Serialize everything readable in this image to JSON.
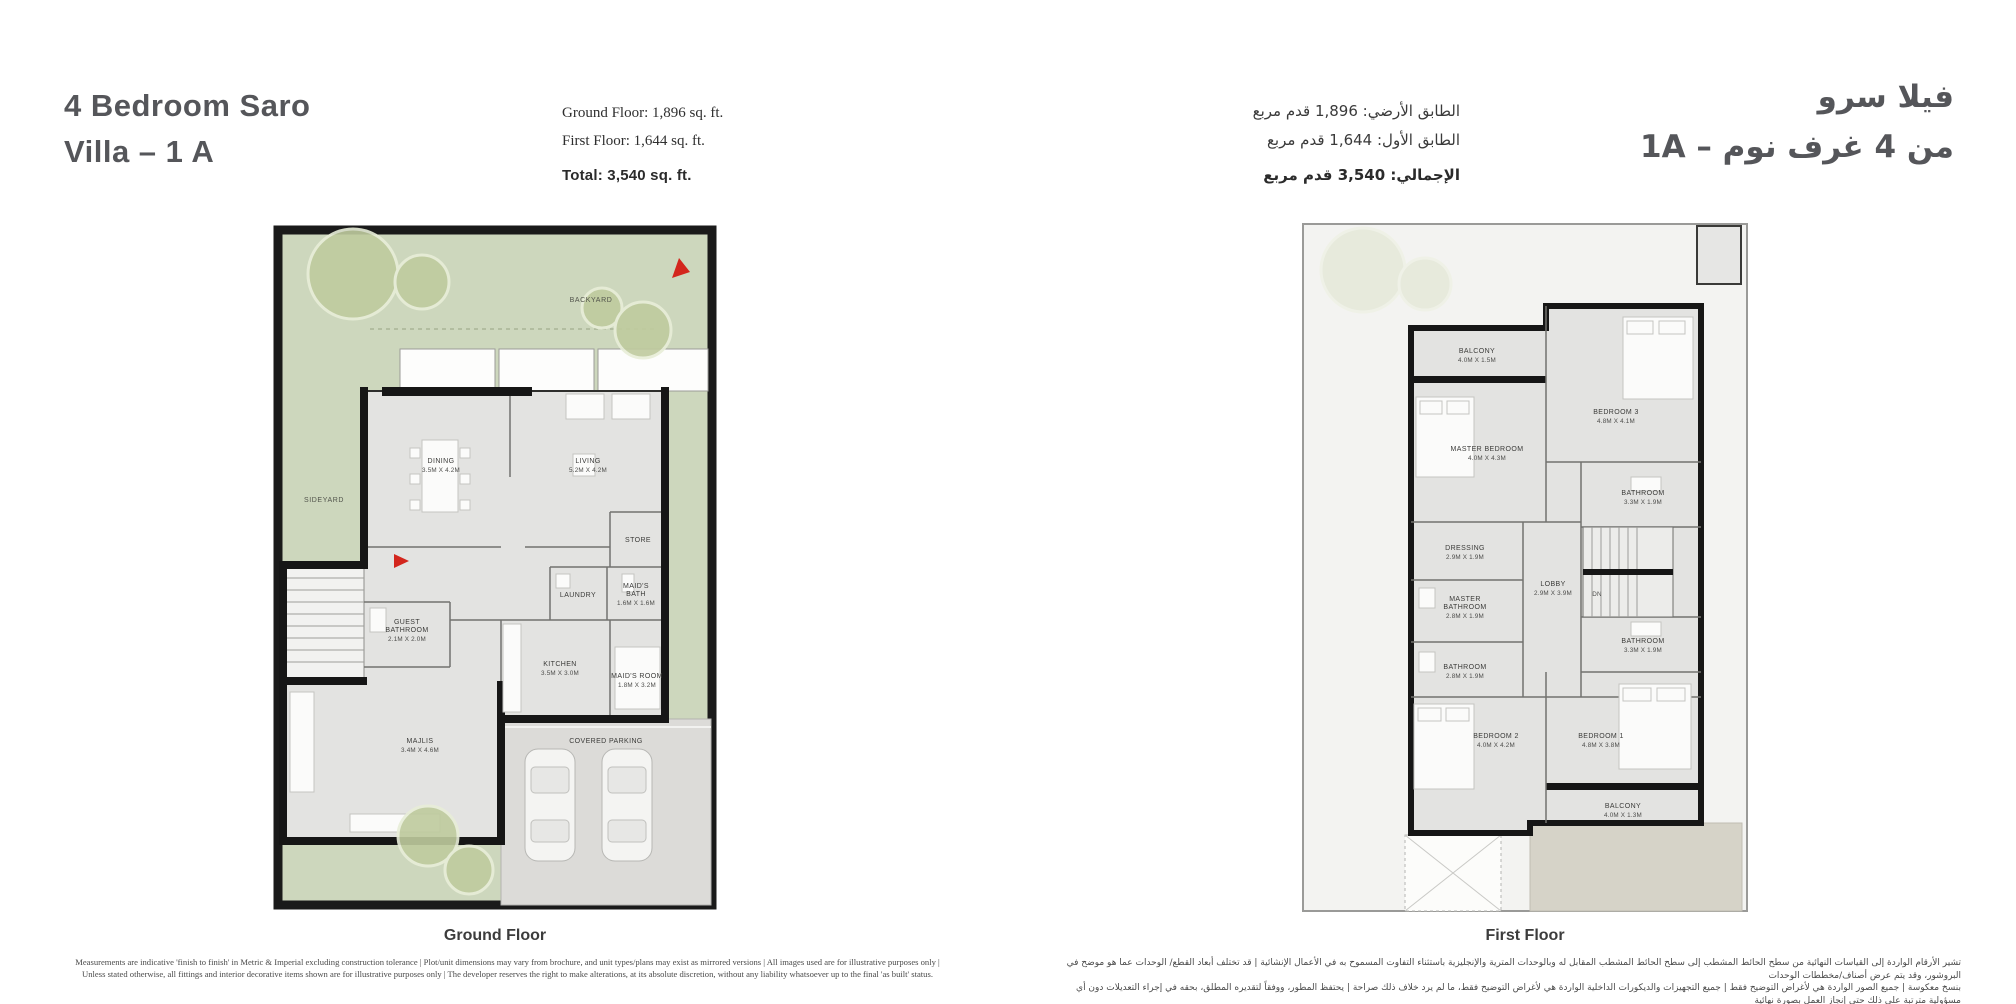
{
  "header": {
    "title_en_line1": "4 Bedroom Saro",
    "title_en_line2": "Villa – 1 A",
    "title_ar_line1": "فيلا سرو",
    "title_ar_line2": "من 4 غرف نوم – 1A",
    "stats_en": {
      "ground": "Ground Floor: 1,896 sq. ft.",
      "first": "First Floor: 1,644 sq. ft.",
      "total": "Total: 3,540 sq. ft."
    },
    "stats_ar": {
      "ground": "الطابق الأرضي: 1,896 قدم مربع",
      "first": "الطابق الأول: 1,644 قدم مربع",
      "total": "الإجمالي: 3,540 قدم مربع"
    }
  },
  "ground_floor": {
    "caption": "Ground Floor",
    "yard": {
      "backyard": "BACKYARD",
      "sideyard": "SIDEYARD"
    },
    "rooms": {
      "dining": {
        "name": "DINING",
        "dims": "3.5M X 4.2M"
      },
      "living": {
        "name": "LIVING",
        "dims": "5.2M X 4.2M"
      },
      "store": {
        "name": "STORE"
      },
      "laundry": {
        "name": "LAUNDRY"
      },
      "maids_bath": {
        "name": "MAID'S",
        "name2": "BATH",
        "dims": "1.6M X 1.6M"
      },
      "guest_bathroom": {
        "name": "GUEST",
        "name2": "BATHROOM",
        "dims": "2.1M X 2.0M"
      },
      "kitchen": {
        "name": "KITCHEN",
        "dims": "3.5M X 3.0M"
      },
      "maids_room": {
        "name": "MAID'S ROOM",
        "dims": "1.8M X 3.2M"
      },
      "majlis": {
        "name": "MAJLIS",
        "dims": "3.4M X 4.6M"
      },
      "parking": {
        "name": "COVERED PARKING"
      }
    }
  },
  "first_floor": {
    "caption": "First Floor",
    "rooms": {
      "balcony_top": {
        "name": "BALCONY",
        "dims": "4.0M X 1.5M"
      },
      "bedroom3": {
        "name": "BEDROOM 3",
        "dims": "4.8M X 4.1M"
      },
      "master_bedroom": {
        "name": "MASTER BEDROOM",
        "dims": "4.0M X 4.3M"
      },
      "bathroom_top": {
        "name": "BATHROOM",
        "dims": "3.3M X 1.9M"
      },
      "dressing": {
        "name": "DRESSING",
        "dims": "2.9M X 1.9M"
      },
      "lobby": {
        "name": "LOBBY",
        "dims": "2.9M X 3.9M"
      },
      "master_bathroom": {
        "name": "MASTER",
        "name2": "BATHROOM",
        "dims": "2.8M X 1.9M"
      },
      "bathroom_left": {
        "name": "BATHROOM",
        "dims": "2.8M X 1.9M"
      },
      "bathroom_right": {
        "name": "BATHROOM",
        "dims": "3.3M X 1.9M"
      },
      "bedroom2": {
        "name": "BEDROOM 2",
        "dims": "4.0M X 4.2M"
      },
      "bedroom1": {
        "name": "BEDROOM 1",
        "dims": "4.8M X 3.8M"
      },
      "balcony_bottom": {
        "name": "BALCONY",
        "dims": "4.0M X 1.3M"
      },
      "stairs_dn": "DN"
    }
  },
  "footer": {
    "disclaimer_en_line1": "Measurements are indicative 'finish to finish' in Metric & Imperial excluding construction tolerance | Plot/unit dimensions may vary from brochure, and unit types/plans may exist as mirrored versions | All images used are for illustrative purposes only |",
    "disclaimer_en_line2": "Unless stated otherwise, all fittings and interior decorative items shown are for illustrative purposes only | The developer reserves the right to make alterations, at its absolute discretion, without any liability whatsoever up to the final 'as built' status.",
    "disclaimer_ar_line1": "تشير الأرقام الواردة إلى القياسات النهائية من سطح الحائط المشطب إلى سطح الحائط المشطب المقابل له وبالوحدات المترية والإنجليزية باستثناء التفاوت المسموح به في الأعمال الإنشائية | قد تختلف أبعاد القطع/ الوحدات عما هو موضح في البروشور، وقد يتم عرض أصناف/مخططات الوحدات",
    "disclaimer_ar_line2": "بنسخ معكوسة | جميع الصور الواردة هي لأغراض التوضيح فقط | جميع التجهيزات والديكورات الداخلية الواردة هي لأغراض التوضيح فقط، ما لم يرد خلاف ذلك صراحة | يحتفظ المطور، ووفقاً لتقديره المطلق، بحقه في إجراء التعديلات دون أي مسؤولية مترتبة على ذلك حتى إنجاز العمل بصورة نهائية"
  },
  "colors": {
    "accent_red": "#d3261d",
    "yard_green": "#cdd7bd",
    "tree_green": "#bfcb9e",
    "house_gray": "#e3e3e1",
    "wall_black": "#161616",
    "title_gray": "#55565a",
    "patio_beige": "#d6d3c8"
  }
}
